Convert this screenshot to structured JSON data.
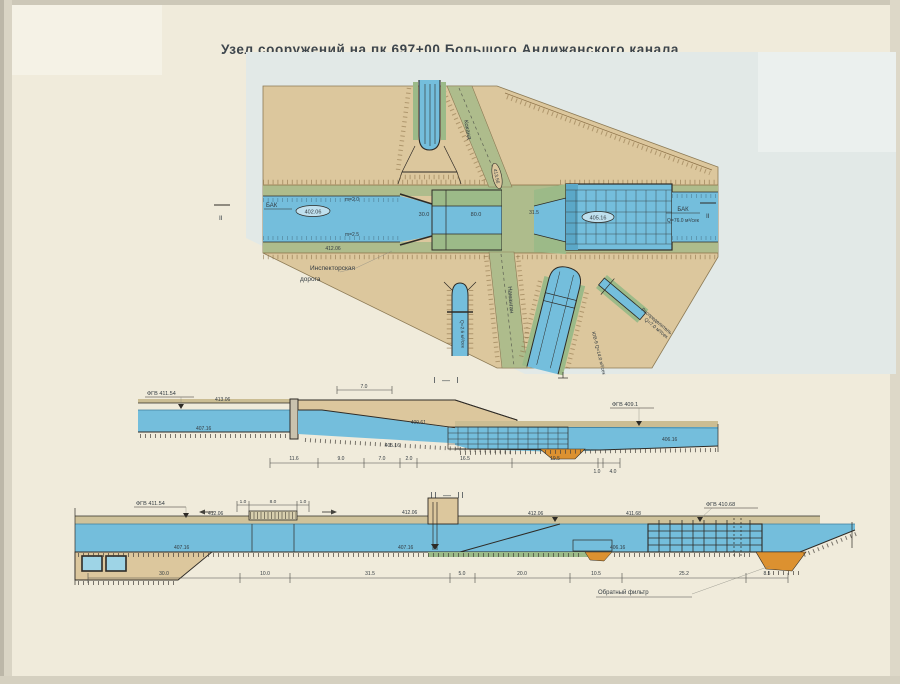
{
  "title": "Узел сооружений на пк 697+00 Большого Андижанского канала",
  "palette": {
    "paper": "#f0ebdb",
    "wash": "#e2e9e7",
    "land": "#dcc79d",
    "water": "#74bedc",
    "water_light": "#bfe0ee",
    "road": "#aebc8c",
    "slope": "#9cba88",
    "filter": "#dc9130",
    "ink": "#2e2b26",
    "brown": "#8a6f45",
    "text": "#3d454c"
  },
  "plan": {
    "section_marker": "II",
    "canal_left_label": "БАК",
    "canal_left_level": "402.06",
    "slope_top": "m=2.0",
    "slope_bottom": "m=2.5",
    "road_level": "412.06",
    "road_kokand": "Коканд",
    "road_kokand_level": "413.56",
    "road_namangan": "Наманган",
    "dim_flume": "30.0",
    "dim_chamber": "80.0",
    "dim_transition": "31.5",
    "basin_level": "405.16",
    "canal_right_label": "БАК",
    "canal_right_flow": "Q=76.0 м³/сек",
    "inspection_road_line1": "Инспекторская",
    "inspection_road_line2": "дорога",
    "distributor_label": "Распределитель",
    "distributor_flow": "Q=7.0 м³/сек",
    "branch_right_label": "ЮВ-9 Q=14.0 м³/сек",
    "branch_left_label": "Q=2.6 м³/сек"
  },
  "section1": {
    "title": "I — I",
    "fgv_left": "ФГВ 411.54",
    "fgv_right": "ФГВ 409.1",
    "levels": {
      "top_left": "413.06",
      "bottom_left": "407.16",
      "berm_right": "409.61",
      "basin": "405.16",
      "bottom_right": "406.16"
    },
    "dim_top": "7.0",
    "dims": [
      "11.6",
      "9.0",
      "7.0",
      "2.0",
      "16.5",
      "19.5",
      "1.0",
      "4.0"
    ]
  },
  "section2": {
    "title": "II — II",
    "fgv_left": "ФГВ 411.54",
    "fgv_right": "ФГВ 410.68",
    "levels": [
      "412.06",
      "407.16",
      "412.06",
      "407.16",
      "412.06",
      "411.68",
      "406.16"
    ],
    "top_dims": [
      "1.0",
      "8.0",
      "1.0"
    ],
    "dims": [
      "30.0",
      "10.0",
      "31.5",
      "5.0",
      "20.0",
      "10.5",
      "25.2",
      "8.5"
    ],
    "filter_label": "Обратный фильтр"
  }
}
